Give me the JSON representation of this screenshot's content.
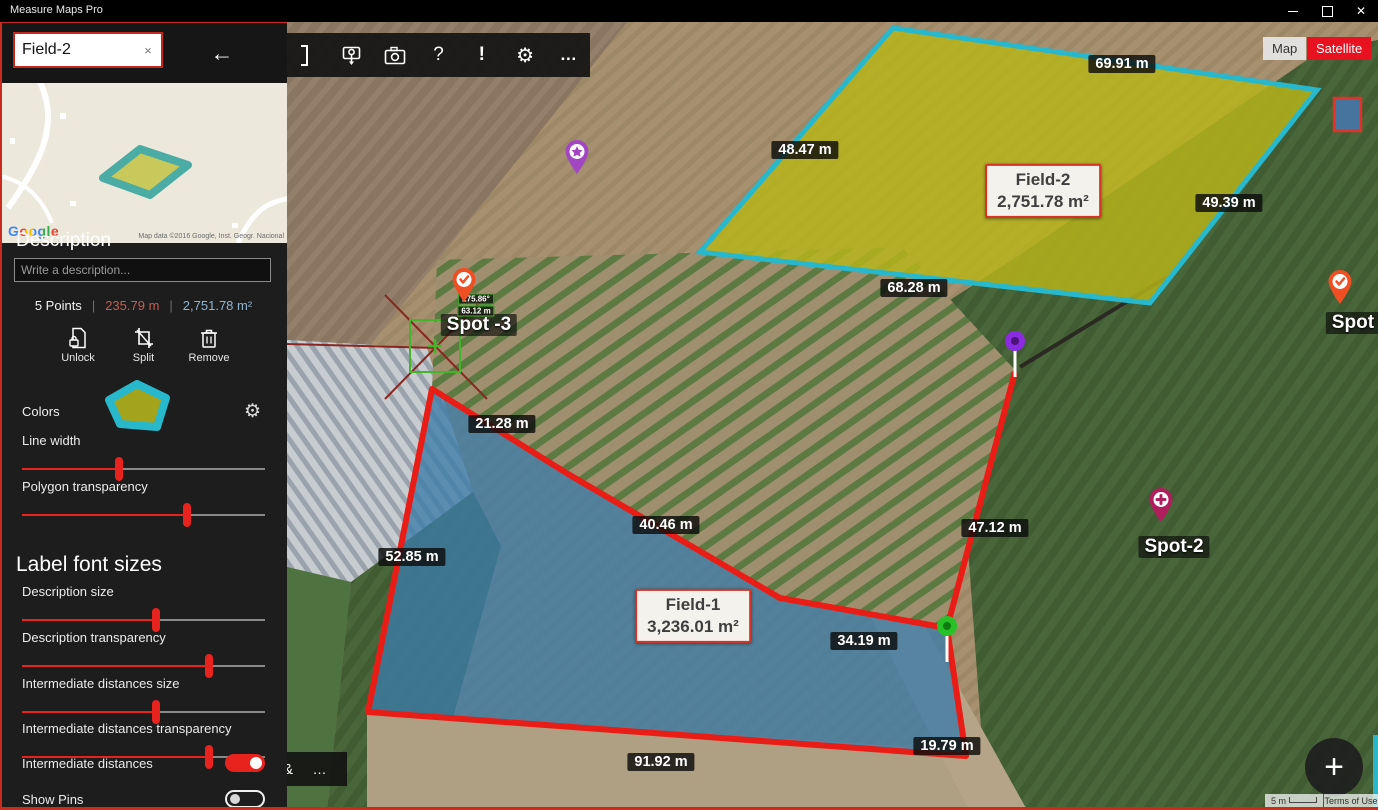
{
  "window": {
    "title": "Measure Maps Pro"
  },
  "glyphs": {
    "back": "←",
    "help": "?",
    "alert": "!",
    "gear": "⚙",
    "more": "…",
    "clear": "×",
    "close": "✕",
    "plus": "+",
    "ampersand": "&"
  },
  "sidebar": {
    "search": {
      "value": "Field-2"
    },
    "minimap": {
      "google": "Google",
      "attribution": "Map data ©2016 Google, Inst. Geogr. Nacional"
    },
    "description_heading": "Description",
    "description_placeholder": "Write a description...",
    "stats": {
      "points": "5 Points",
      "divider": "|",
      "perimeter": "235.79 m",
      "area": "2,751.78 m²"
    },
    "actions": [
      {
        "label": "Unlock"
      },
      {
        "label": "Split"
      },
      {
        "label": "Remove"
      }
    ],
    "colors_label": "Colors",
    "label_font_sizes_heading": "Label font sizes",
    "sliders": [
      {
        "label": "Line width",
        "pos": 40
      },
      {
        "label": "Polygon transparency",
        "pos": 68
      },
      {
        "label": "Description size",
        "pos": 55
      },
      {
        "label": "Description transparency",
        "pos": 77
      },
      {
        "label": "Intermediate distances size",
        "pos": 55
      },
      {
        "label": "Intermediate distances transparency",
        "pos": 77
      }
    ],
    "toggles": [
      {
        "label": "Intermediate distances",
        "on": true
      },
      {
        "label": "Show Pins",
        "on": false
      }
    ]
  },
  "map": {
    "view_toggle": {
      "map": "Map",
      "satellite": "Satellite",
      "active": "Satellite"
    },
    "field_boxes": [
      {
        "name": "Field-2",
        "area": "2,751.78 m²"
      },
      {
        "name": "Field-1",
        "area": "3,236.01 m²"
      }
    ],
    "distance_labels": [
      {
        "text": "69.91 m"
      },
      {
        "text": "48.47 m"
      },
      {
        "text": "49.39 m"
      },
      {
        "text": "68.28 m"
      },
      {
        "text": "21.28 m"
      },
      {
        "text": "40.46 m"
      },
      {
        "text": "52.85 m"
      },
      {
        "text": "47.12 m"
      },
      {
        "text": "34.19 m"
      },
      {
        "text": "19.79 m"
      },
      {
        "text": "91.92 m"
      }
    ],
    "spot_labels": [
      {
        "text": "Spot -3"
      },
      {
        "text": "Spot-2"
      },
      {
        "text": "Spot -4"
      }
    ],
    "angle_label": "275.86°",
    "segment_label": "63.12 m",
    "scale_label": "5 m",
    "terms_label": "Terms of Use"
  },
  "colors": {
    "accent_red": "#e8231e",
    "field2_fill": "#b8b619",
    "field2_stroke": "#27b8cd",
    "field1_fill": "#3c7ba8",
    "field1_stroke": "#ea1c16"
  }
}
